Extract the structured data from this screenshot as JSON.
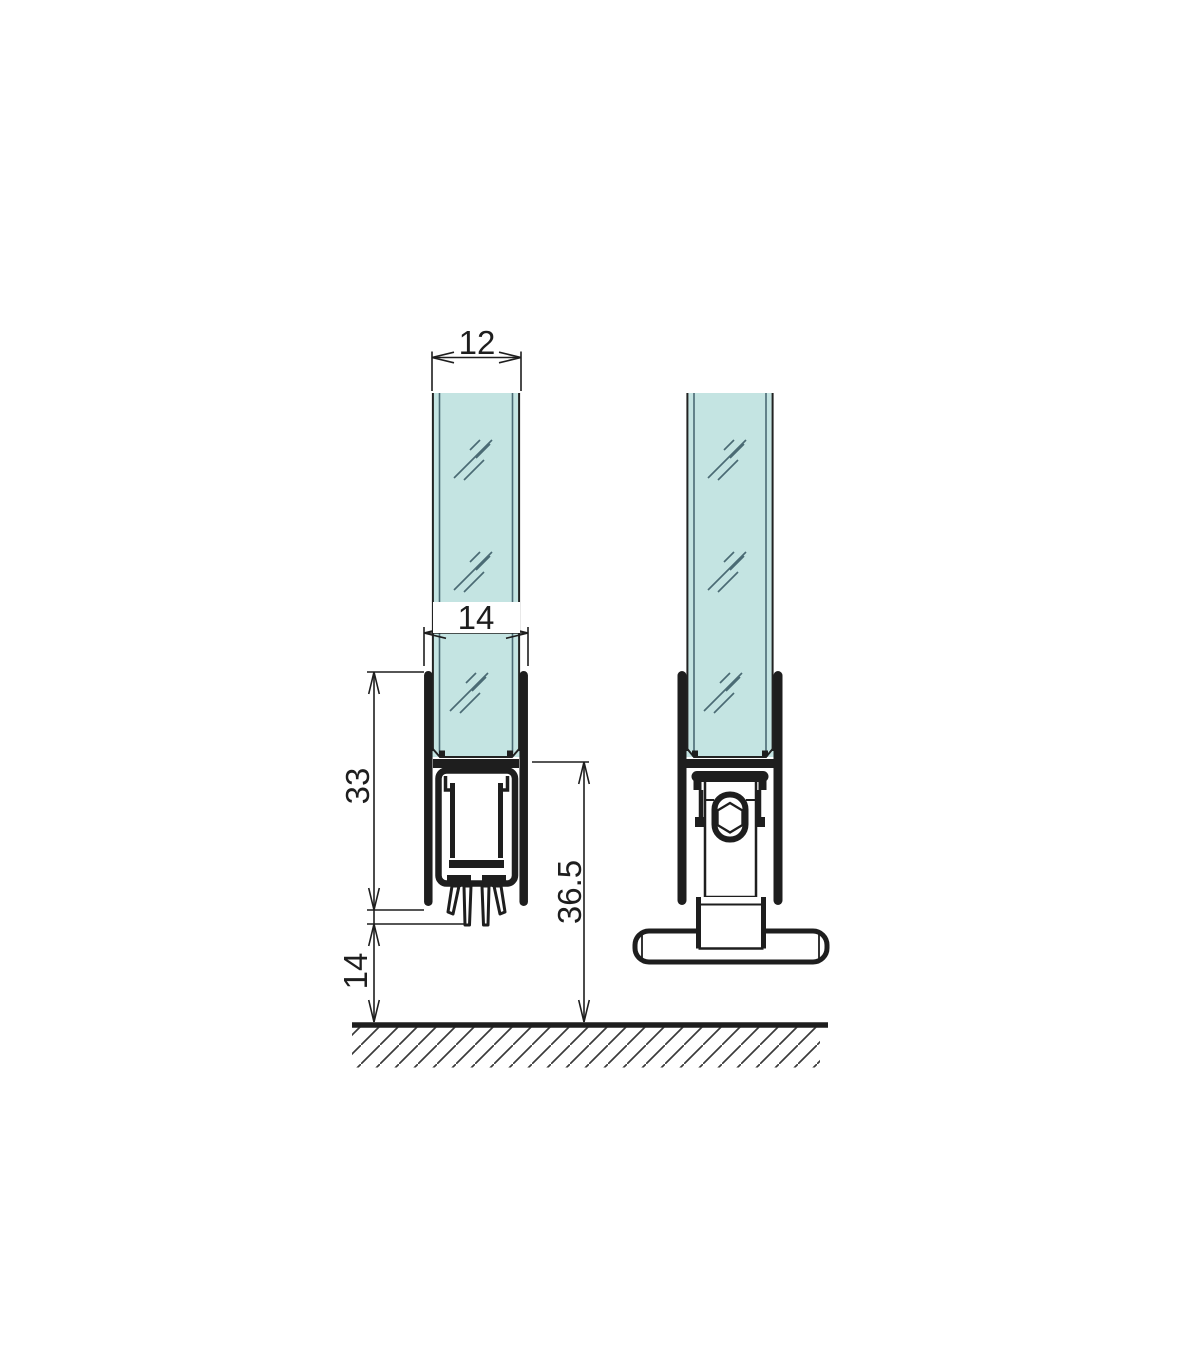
{
  "labels": {
    "glass_thickness": "12",
    "channel_width": "14",
    "profile_height": "33",
    "overall_height": "36.5",
    "floor_clearance": "14"
  },
  "colors": {
    "glass_fill": "#c4e4e2",
    "glass_line": "#4a6a74",
    "outline": "#1e1e1e",
    "hatch": "#3a3a3a",
    "background": "#ffffff"
  }
}
